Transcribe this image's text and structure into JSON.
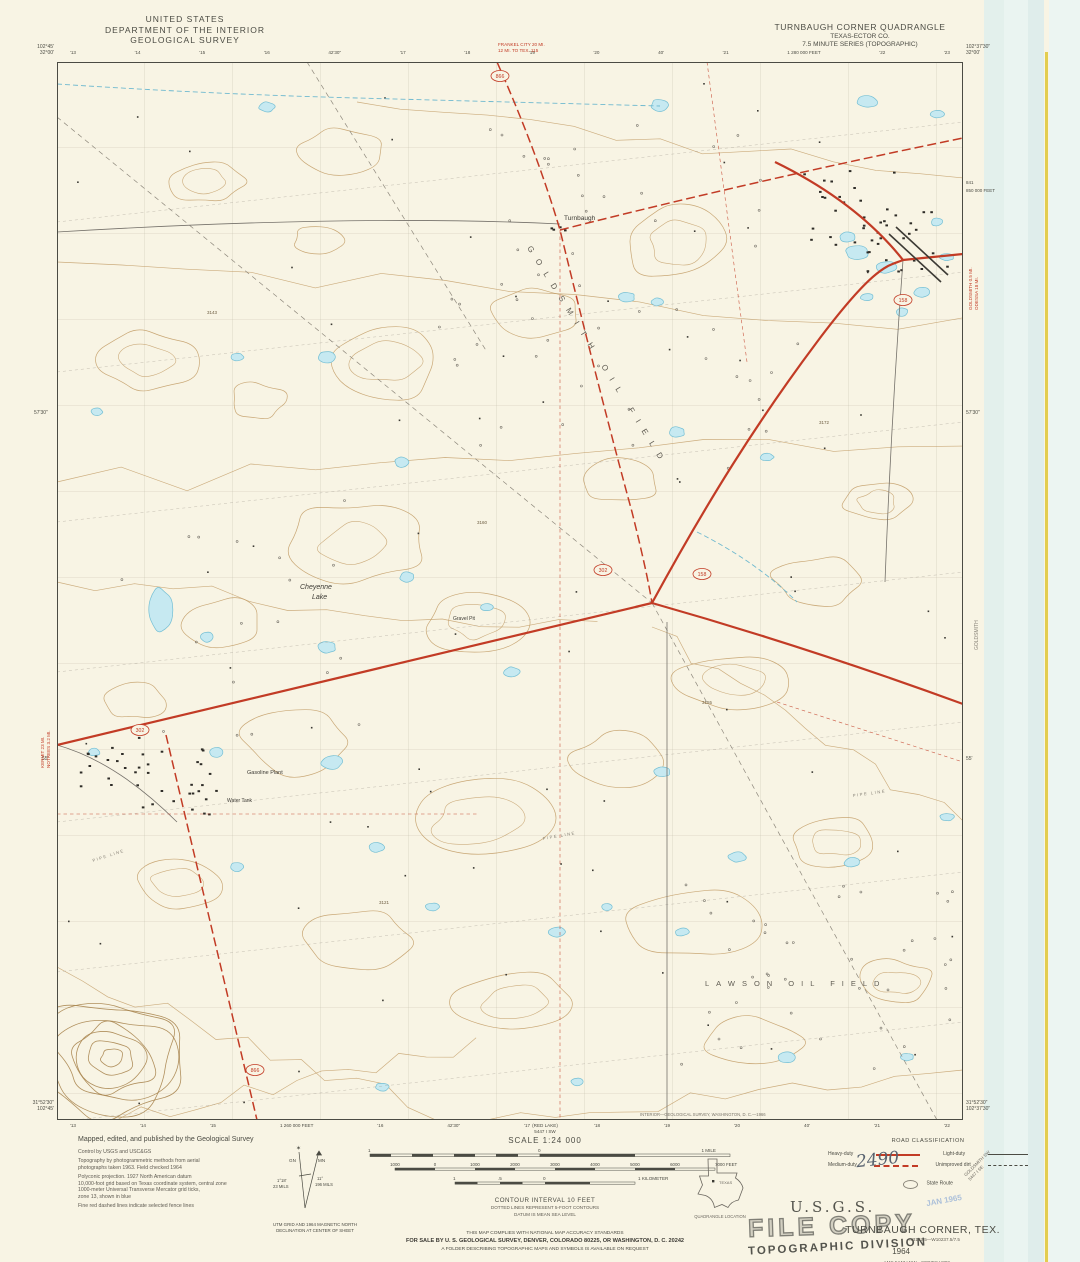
{
  "header": {
    "agency_line1": "UNITED STATES",
    "agency_line2": "DEPARTMENT OF THE INTERIOR",
    "agency_line3": "GEOLOGICAL SURVEY",
    "quad_title": "TURNBAUGH CORNER QUADRANGLE",
    "quad_subtitle1": "TEXAS-ECTOR CO.",
    "quad_subtitle2": "7.5 MINUTE SERIES (TOPOGRAPHIC)"
  },
  "corners": {
    "top_left_lon": "102°45'",
    "top_left_lat": "32°00'",
    "top_right_lon": "102°37'30\"",
    "top_right_lat": "32°00'",
    "bottom_left_lat": "31°52'30\"",
    "bottom_left_lon": "102°45'",
    "bottom_right_lat": "31°52'30\"",
    "bottom_right_lon": "102°37'30\""
  },
  "collar": {
    "top_ticks": [
      "'13",
      "'14",
      "'15",
      "'16",
      "42'30\"",
      "'17",
      "'18",
      "'19",
      "'20",
      "40'",
      "'21",
      "1 280 000 FEET",
      "'22",
      "'23"
    ],
    "bottom_ticks": [
      "'13",
      "'14",
      "'15",
      "1 260 000 FEET",
      "'16",
      "42'30\"",
      "'17",
      "'18",
      "'19",
      "'20",
      "40'",
      "'21",
      "'22"
    ],
    "left_edge_upper": "57'30\"",
    "left_edge_lower": "55'",
    "right_edge_upper": "57'30\"",
    "right_edge_lower": "55'",
    "right_inside_num": "841",
    "right_inside_feet": "850 000 FEET",
    "print_note": "INTERIOR—GEOLOGICAL SURVEY, WASHINGTON, D. C.—1966"
  },
  "edge_notes": {
    "top_line1": "FRANKEL CITY 20 MI.",
    "top_line2": "12 MI. TO TEX. 115",
    "left_line1": "KERMIT 23 MI.",
    "left_line2": "NOTREES 3.2 MI.",
    "right_line1": "GOLDSMITH 0.5 MI.",
    "right_line2": "ODESSA 18 MI."
  },
  "adjacent_quads": {
    "bottom_center_name": "(RED LAKE)",
    "bottom_center_ref": "5447 I SW",
    "corner_diag_name": "GOLDSMITH SW",
    "corner_diag_ref": "5447 I SE",
    "right_margin_name": "GOLDSMITH"
  },
  "map_labels": {
    "town": "Turnbaugh",
    "lake_line1": "Cheyenne",
    "lake_line2": "Lake",
    "oilfield1": "GOLDSMITH OIL FIELD",
    "oilfield2": "LAWSON OIL FIELD",
    "gravel_pit": "Gravel Pit",
    "gasoline_plant": "Gasoline Plant",
    "water_tank": "Water Tank",
    "pipeline1": "PIPE LINE",
    "pipeline2": "PIPE LINE",
    "pipeline3": "PIPE LINE",
    "spot_elev1": "3143",
    "spot_elev2": "3160",
    "spot_elev3": "3155",
    "spot_elev4": "3121",
    "spot_elev5": "3172",
    "shield_302": "302",
    "shield_158": "158",
    "shield_866": "866"
  },
  "scale_block": {
    "scale_label": "SCALE 1:24 000",
    "mile_left": "1",
    "mile_zero": "0",
    "mile_right": "1 MILE",
    "feet_labels": [
      "1000",
      "0",
      "1000",
      "2000",
      "3000",
      "4000",
      "5000",
      "6000",
      "7000 FEET"
    ],
    "km_left": "1",
    "km_half": ".5",
    "km_zero": "0",
    "km_right": "1 KILOMETER",
    "contour_line1": "CONTOUR INTERVAL 10 FEET",
    "contour_line2": "DOTTED LINES REPRESENT 5-FOOT CONTOURS",
    "contour_line3": "DATUM IS MEAN SEA LEVEL"
  },
  "compliance": {
    "line1": "THIS MAP COMPLIES WITH NATIONAL MAP ACCURACY STANDARDS",
    "line2": "FOR SALE BY U. S. GEOLOGICAL SURVEY, DENVER, COLORADO 80225, OR WASHINGTON, D. C. 20242",
    "line3": "A FOLDER DESCRIBING TOPOGRAPHIC MAPS AND SYMBOLS IS AVAILABLE ON REQUEST"
  },
  "credits": {
    "lines": [
      "Mapped, edited, and published by the Geological Survey",
      "Control by USGS and USC&GS",
      "Topography by photogrammetric methods from aerial",
      "photographs taken 1963.  Field checked 1964",
      "Polyconic projection.  1927 North American datum",
      "10,000-foot grid based on Texas coordinate system, central zone",
      "1000-meter Universal Transverse Mercator grid ticks,",
      "zone 13, shown in blue",
      "Fine red dashed lines indicate selected fence lines"
    ]
  },
  "declination": {
    "gn_label": "GN",
    "mn_label": "MN",
    "gn_angle": "1°18'",
    "gn_mils": "23 MILS",
    "mn_angle": "11°",
    "mn_mils": "196 MILS",
    "caption1": "UTM GRID AND 1964 MAGNETIC NORTH",
    "caption2": "DECLINATION AT CENTER OF SHEET"
  },
  "road_classification": {
    "title": "ROAD CLASSIFICATION",
    "heavy": "Heavy-duty",
    "medium": "Medium-duty",
    "light": "Light-duty",
    "unimproved": "Unimproved dirt",
    "state_route": "State Route"
  },
  "location_inset": {
    "state_label": "TEXAS",
    "caption": "QUADRANGLE LOCATION"
  },
  "title_block": {
    "stamp_usgs": "U.S.G.S.",
    "stamp_file": "FILE COPY",
    "stamp_division": "TOPOGRAPHIC DIVISION",
    "name": "TURNBAUGH CORNER, TEX.",
    "coords": "N3152.5—W10237.5/7.5",
    "year": "1964",
    "series": "AMS 5447 I NW—SERIES V882",
    "handwritten": "2490",
    "date_stamp": "JAN 1965"
  },
  "colors": {
    "road_red": "#c23b25",
    "water_fill": "#c6e9f1",
    "water_outline": "#74bfd4",
    "contour_brown": "#c19a63",
    "paper": "#f8f4e4"
  }
}
